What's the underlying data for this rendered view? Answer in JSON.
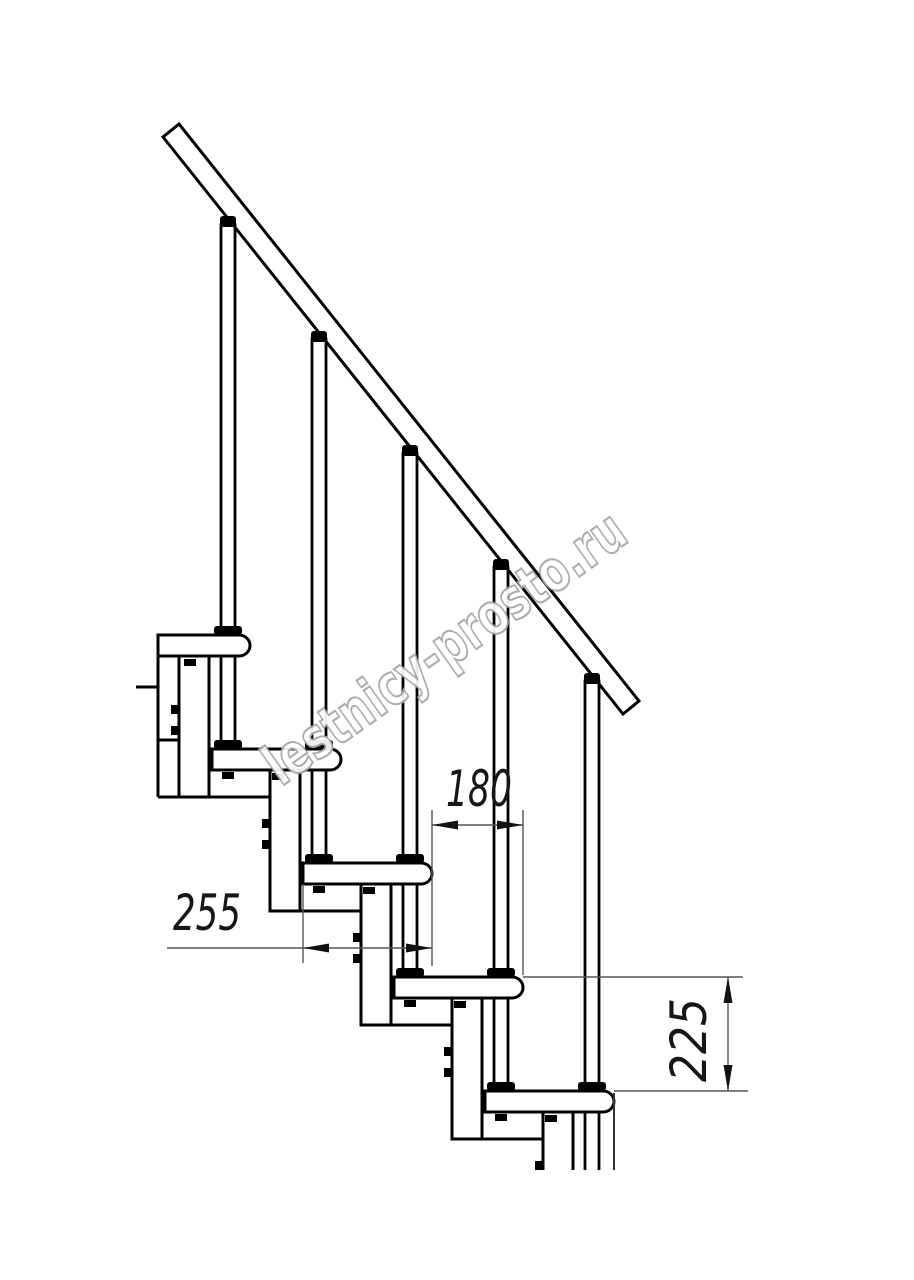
{
  "drawing": {
    "type": "staircase-section-technical-drawing",
    "watermark": {
      "text": "lestnicy-prosto.ru",
      "outline_color": "#a6a6a6"
    },
    "dimensions": {
      "run": {
        "value": "180"
      },
      "depth": {
        "value": "255"
      },
      "rise": {
        "value": "225"
      }
    },
    "structure": {
      "tread_count": 5,
      "baluster_count": 5,
      "support_column_count": 5,
      "handrail": "diagonal"
    },
    "colors": {
      "line": "#000000",
      "dimension_line": "#555555",
      "dimension_text": "#161616",
      "background": "#ffffff"
    }
  }
}
